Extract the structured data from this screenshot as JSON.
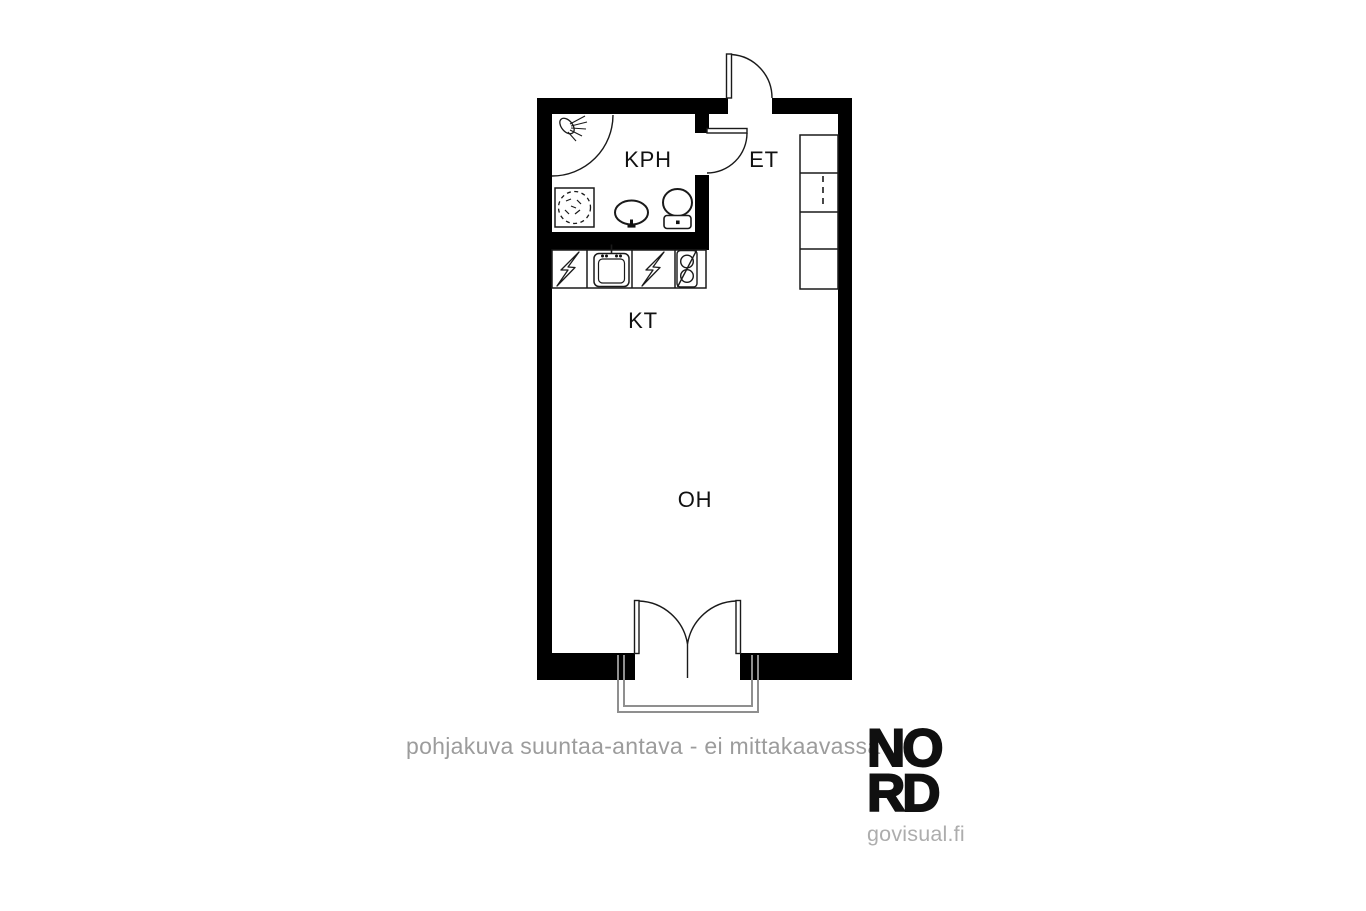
{
  "page": {
    "background_color": "#ffffff"
  },
  "floorplan": {
    "rooms": [
      {
        "id": "kph",
        "label": "KPH",
        "meaning": "bathroom"
      },
      {
        "id": "et",
        "label": "ET",
        "meaning": "entrance hall"
      },
      {
        "id": "kt",
        "label": "KT",
        "meaning": "kitchenette"
      },
      {
        "id": "oh",
        "label": "OH",
        "meaning": "living room"
      }
    ],
    "fixtures": [
      "shower-icon",
      "shower-curtain-arc",
      "washing-machine-reservation-icon",
      "bathroom-sink-icon",
      "toilet-icon",
      "bathroom-door",
      "entrance-door",
      "kitchen-counter",
      "appliance-reservation-bolt-icon",
      "kitchen-sink-icon",
      "appliance-reservation-bolt-icon",
      "stove-reservation-icon",
      "wardrobe",
      "balcony-double-door",
      "balcony-outline"
    ],
    "colors": {
      "wall": "#000000",
      "line": "#1a1a1a",
      "balcony": "#8f8f8f",
      "label": "#111111"
    }
  },
  "footer": {
    "disclaimer": "pohjakuva suuntaa-antava - ei mittakaavassa"
  },
  "logo": {
    "line1": "NO",
    "line2": "RD",
    "url_text": "govisual.fi",
    "color": "#101010",
    "sub_color": "#adadad"
  }
}
